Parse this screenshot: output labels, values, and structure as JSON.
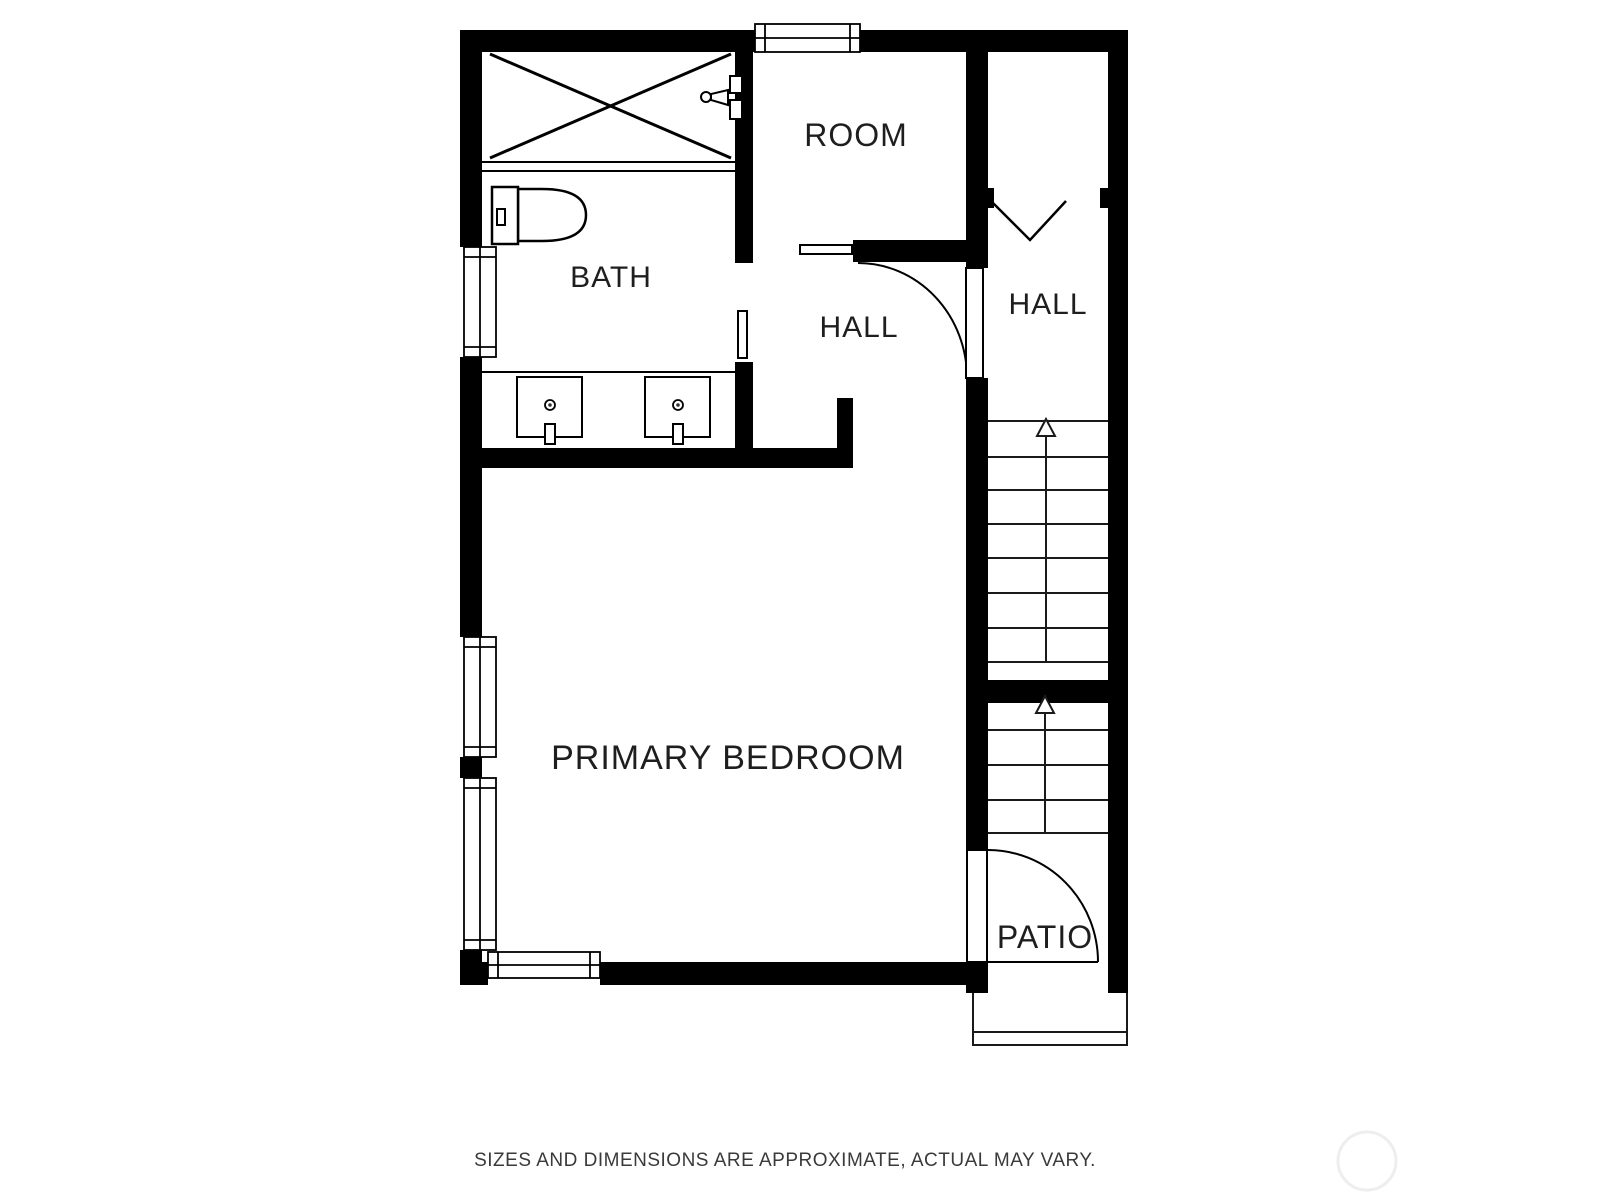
{
  "colors": {
    "background": "#ffffff",
    "wall": "#000000",
    "line": "#1a1a1a",
    "label": "#1e1e1e",
    "footer_text": "#3a3a3a",
    "watermark": "#eeeeee"
  },
  "rooms": {
    "room": {
      "label": "ROOM"
    },
    "bath": {
      "label": "BATH"
    },
    "hall_inner": {
      "label": "HALL"
    },
    "hall_stairs": {
      "label": "HALL"
    },
    "primary_bedroom": {
      "label": "PRIMARY BEDROOM"
    },
    "patio": {
      "label": "PATIO"
    }
  },
  "fixtures": {
    "shower": "shower-stall-x",
    "shower_head": "shower-head",
    "toilet": "toilet",
    "vanity": "double-vanity",
    "sink_left": "sink",
    "sink_right": "sink",
    "stairs_upper": "stairs-up",
    "stairs_lower": "stairs-up",
    "door_hall": "swing-door",
    "door_patio": "swing-door",
    "door_room": "sliding-door",
    "door_bath": "pocket-door",
    "door_double": "double-door-v",
    "window_count": 5
  },
  "footer": {
    "disclaimer": "SIZES AND DIMENSIONS ARE APPROXIMATE, ACTUAL MAY VARY."
  }
}
